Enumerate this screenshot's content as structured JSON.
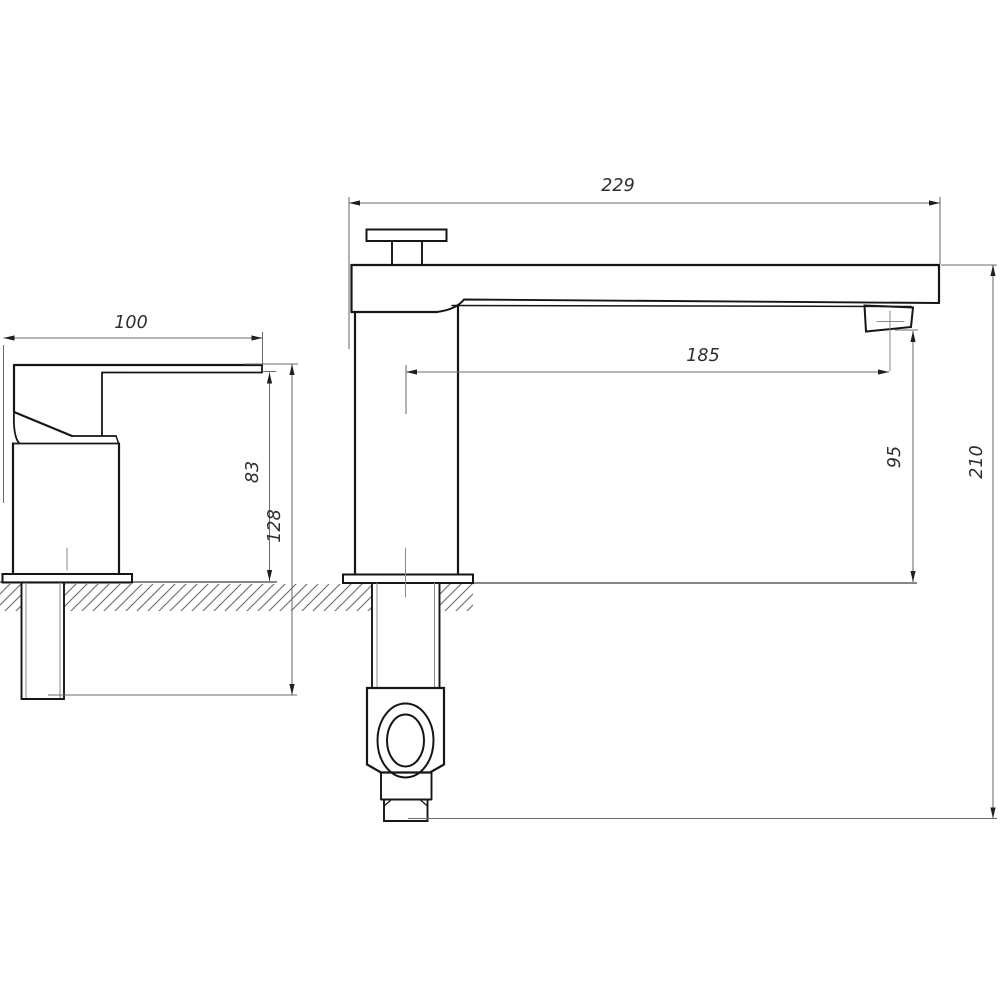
{
  "drawing": {
    "type": "technical-dimension-drawing",
    "subject": "deck-mounted single-lever basin faucet, two orthographic views (side view left, front view right)",
    "units": "mm",
    "colors": {
      "background": "#ffffff",
      "outline": "#161616",
      "thin_line": "#6b6b6b",
      "surface_line": "#3f3f3f",
      "hatch": "#6a6a6a",
      "text": "#2e2e2e"
    },
    "dimensions": [
      {
        "id": "spout-overall-length",
        "label": "229",
        "orientation": "horizontal",
        "view": "front"
      },
      {
        "id": "side-body-depth",
        "label": "100",
        "orientation": "horizontal",
        "view": "side"
      },
      {
        "id": "spout-reach",
        "label": "185",
        "orientation": "horizontal",
        "view": "front"
      },
      {
        "id": "spout-underside-height",
        "label": "83",
        "orientation": "vertical",
        "view": "side"
      },
      {
        "id": "height-to-shank-bottom",
        "label": "128",
        "orientation": "vertical",
        "view": "side"
      },
      {
        "id": "aerator-height",
        "label": "95",
        "orientation": "vertical",
        "view": "front"
      },
      {
        "id": "overall-height",
        "label": "210",
        "orientation": "vertical",
        "view": "front"
      }
    ]
  }
}
